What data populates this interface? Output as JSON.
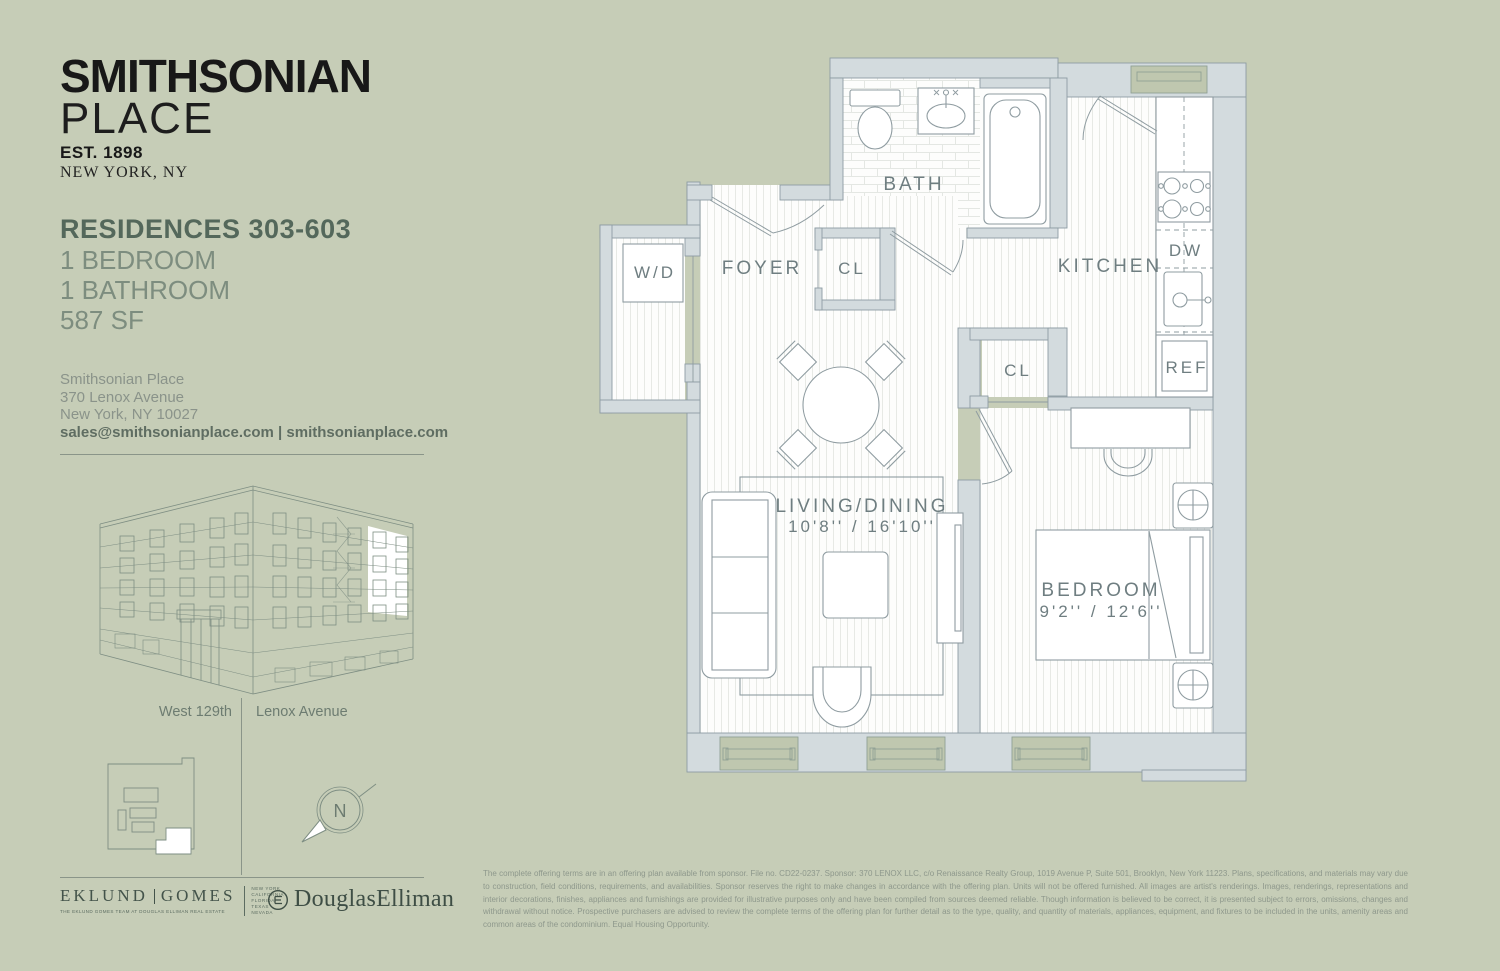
{
  "colors": {
    "background": "#c6cdb7",
    "wall_fill": "#d3dbde",
    "window_fill": "#bfc7af",
    "heading_green": "#54685b",
    "body_green": "#7d8d7f",
    "plan_label": "#6f7e81",
    "logo_ink": "#181818"
  },
  "branding": {
    "name_line1": "SMITHSONIAN",
    "name_line2": "PLACE",
    "established": "EST. 1898",
    "location": "NEW YORK, NY"
  },
  "residence": {
    "title": "RESIDENCES 303-603",
    "line1": "1 BEDROOM",
    "line2": "1 BATHROOM",
    "line3": "587 SF"
  },
  "contact": {
    "line1": "Smithsonian Place",
    "line2": "370 Lenox Avenue",
    "line3": "New York, NY 10027",
    "links": "sales@smithsonianplace.com | smithsonianplace.com"
  },
  "streets": {
    "left": "West 129th",
    "right": "Lenox Avenue"
  },
  "compass": {
    "north": "N"
  },
  "floorplan": {
    "bath": "BATH",
    "foyer": "FOYER",
    "closet_foyer": "CL",
    "kitchen": "KITCHEN",
    "washer_dryer": "W/D",
    "dishwasher": "DW",
    "refrigerator": "REF",
    "closet_bedroom": "CL",
    "living_title": "LIVING/DINING",
    "living_dims": "10'8'' / 16'10''",
    "bedroom_title": "BEDROOM",
    "bedroom_dims": "9'2'' / 12'6''"
  },
  "brokers": {
    "eklund": "EKLUND",
    "gomes": "GOMES",
    "tagline": "THE EKLUND GOMES TEAM AT DOUGLAS ELLIMAN REAL ESTATE",
    "regions": [
      "NEW YORK",
      "CALIFORNIA",
      "FLORIDA",
      "TEXAS",
      "NEVADA"
    ],
    "elliman": "DouglasElliman"
  },
  "disclaimer": "The complete offering terms are in an offering plan available from sponsor. File no. CD22-0237. Sponsor: 370 LENOX LLC, c/o Renaissance Realty Group, 1019 Avenue P, Suite 501, Brooklyn, New York 11223. Plans, specifications, and materials may vary due to construction, field conditions, requirements, and availabilities. Sponsor reserves the right to make changes in accordance with the offering plan. Units will not be offered furnished. All images are artist's renderings. Images, renderings, representations and interior decorations, finishes, appliances and furnishings are provided for illustrative purposes only and have been compiled from sources deemed reliable. Though information is believed to be correct, it is presented subject to errors, omissions, changes and withdrawal without notice. Prospective purchasers are advised to review the complete terms of the offering plan for further detail as to the type, quality, and quantity of materials, appliances, equipment, and fixtures to be included in the units, amenity areas and common areas of the condominium. Equal Housing Opportunity."
}
